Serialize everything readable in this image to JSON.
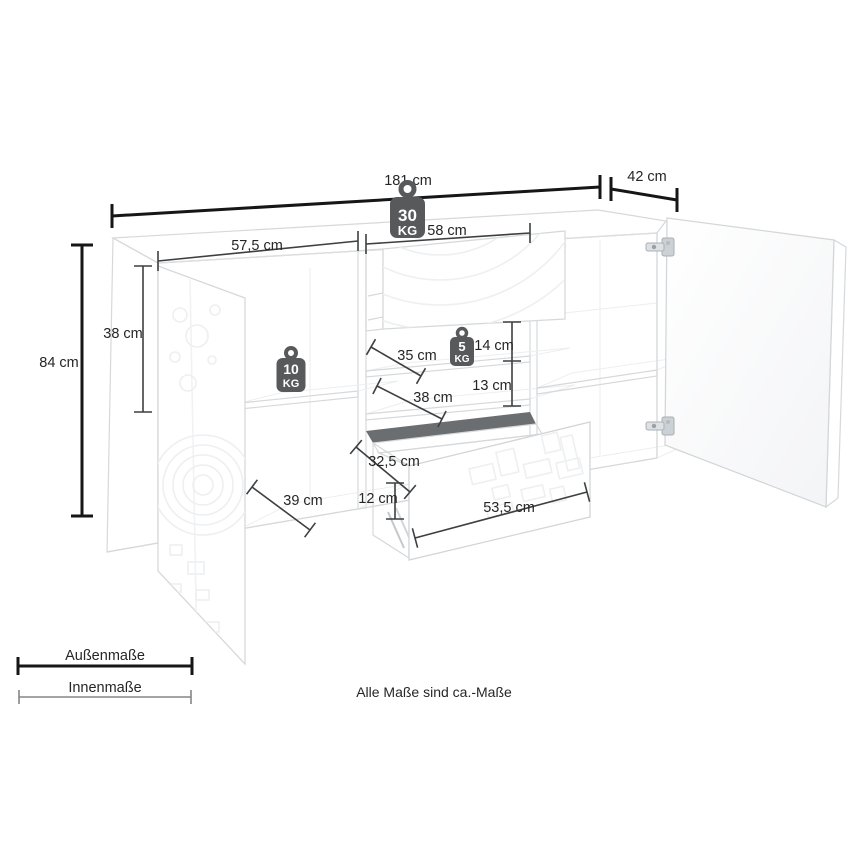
{
  "diagram": {
    "title": "sideboard-dimension-diagram",
    "note": "Alle Maße sind ca.-Maße",
    "legend": {
      "outer": "Außenmaße",
      "inner": "Innenmaße"
    },
    "dimensions": {
      "total_width": "181 cm",
      "total_depth": "42 cm",
      "total_height": "84 cm",
      "left_door_inner_height": "38 cm",
      "left_section_width": "57,5 cm",
      "center_section_width": "58 cm",
      "center_shelf_depth": "35 cm",
      "center_top_gap_height": "14 cm",
      "center_bottom_gap_height": "13 cm",
      "center_bottom_depth": "38 cm",
      "left_shelf_depth": "39 cm",
      "drawer_inner_depth": "32,5 cm",
      "drawer_inner_height": "12 cm",
      "drawer_front_width": "53,5 cm"
    },
    "load_capacity": {
      "top": {
        "value": "30",
        "unit": "KG"
      },
      "left_shelf": {
        "value": "10",
        "unit": "KG"
      },
      "center_shelf": {
        "value": "5",
        "unit": "KG"
      }
    },
    "colors": {
      "outer_dimension_line": "#161616",
      "inner_dimension_line": "#3d3f40",
      "weight_badge": "#57595b",
      "furniture_edge": "#d6d8da"
    }
  }
}
